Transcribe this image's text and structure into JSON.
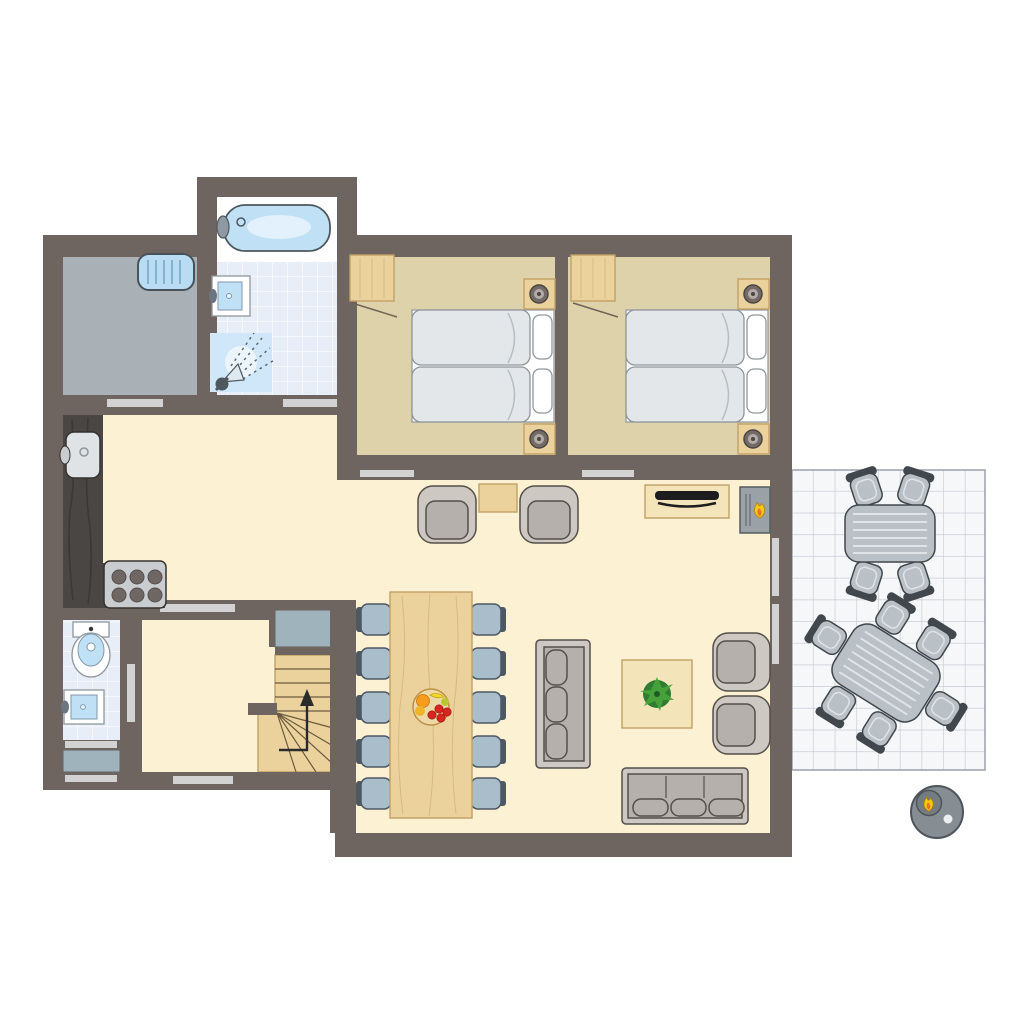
{
  "scene": {
    "type": "architectural-floor-plan",
    "view": "top-down-2d",
    "background": "#ffffff",
    "text_labels": []
  },
  "colors": {
    "wall": "#6e6460",
    "outline": "#544f4a",
    "floor_living": "#fcf1d2",
    "floor_bedroom": "#ddd2a9",
    "floor_utility": "#a9b1b6",
    "tile": "#e8eef8",
    "tile_line": "#f9fbff",
    "terrace": "#f6f7f9",
    "terrace_line": "#c9cdd5",
    "marker": "#d2d2d2",
    "mat": "#9fb3bd",
    "wood": "#ebd29d",
    "wood_light": "#f3e4ba",
    "wood_dark": "#c1a167",
    "counter": "#4a4643",
    "counter_grain": "#36322f",
    "steel": "#c9cdd0",
    "burner": "#6e6764",
    "white_fixture": "#ffffff",
    "fixture_line": "#8f969c",
    "water": "#bfe0f5",
    "water_dark": "#4e585f",
    "sofa": "#b5b0ab",
    "sofa_light": "#cdc8c1",
    "chair_blue": "#a9bdcb",
    "chair_dark": "#4e5863",
    "outdoor": "#b9c0c6",
    "outdoor_dark": "#40474d",
    "outdoor_pad": "#dfe3e6",
    "bed_fill": "#e3e7ea",
    "bed_border": "#8f969c",
    "lamp_base": "#746b66",
    "lamp_dark": "#4c4541",
    "radiator": "#badcf2",
    "radiator_line": "#6fa6c4",
    "plant": "#2e7d32",
    "plant_leaf": "#4aa53c",
    "plant_core": "#1c5c24",
    "flame_yellow": "#f6c915",
    "flame_orange": "#e8742a",
    "fruit_orange": "#f59b1e",
    "fruit_yellow": "#f2d832",
    "fruit_red": "#d6261f",
    "bowl": "#ecd9a6",
    "bowl_edge": "#bd9045",
    "bbq": "#868e93",
    "bbq_dark": "#4e555a",
    "stair_line": "#6b5b3e",
    "arrow": "#2b2b2b"
  },
  "rooms": [
    {
      "id": "utility-room",
      "floor": "grey",
      "items": [
        "radiator"
      ]
    },
    {
      "id": "bathroom",
      "floor": "light-blue-tiles",
      "items": [
        "bathtub",
        "washbasin",
        "shower"
      ]
    },
    {
      "id": "bedroom-1",
      "floor": "tan",
      "items": [
        "wardrobe",
        "double-bed",
        "pillow",
        "pillow",
        "nightstand-with-lamp",
        "nightstand-with-lamp"
      ]
    },
    {
      "id": "bedroom-2",
      "floor": "tan",
      "items": [
        "wardrobe",
        "double-bed",
        "pillow",
        "pillow",
        "nightstand-with-lamp",
        "nightstand-with-lamp"
      ]
    },
    {
      "id": "kitchen",
      "floor": "cream",
      "items": [
        "l-shaped-counter",
        "sink",
        "stove-6-burners"
      ]
    },
    {
      "id": "living-dining-room",
      "floor": "cream",
      "items": [
        "armchair",
        "armchair",
        "side-table",
        "tv-cabinet",
        "wall-fireplace",
        "dining-table",
        "dining-chairs-x10",
        "fruit-bowl",
        "sofa-3-seat-vertical",
        "sofa-3-seat-horizontal",
        "coffee-table",
        "potted-plant",
        "lounge-chair",
        "lounge-chair"
      ]
    },
    {
      "id": "toilet-room",
      "floor": "light-blue-tiles",
      "items": [
        "toilet",
        "washbasin"
      ]
    },
    {
      "id": "hallway",
      "floor": "cream",
      "items": [
        "entrance-door-marker"
      ]
    },
    {
      "id": "staircase",
      "floor": "wood",
      "items": [
        "winder-stairs",
        "up-arrow",
        "closet"
      ]
    },
    {
      "id": "terrace",
      "floor": "white-tiles",
      "items": [
        "patio-table-4-chairs",
        "patio-table-6-chairs",
        "round-bbq"
      ]
    }
  ],
  "legend": {
    "door_window_marker": "light grey strip on wall",
    "flame_icon": "fireplace / bbq",
    "up_arrow_icon": "stairs direction up"
  },
  "counts": {
    "bedrooms": 2,
    "dining_chairs": 10,
    "patio_chairs": 10,
    "sofas": 2,
    "armchairs": 4
  }
}
